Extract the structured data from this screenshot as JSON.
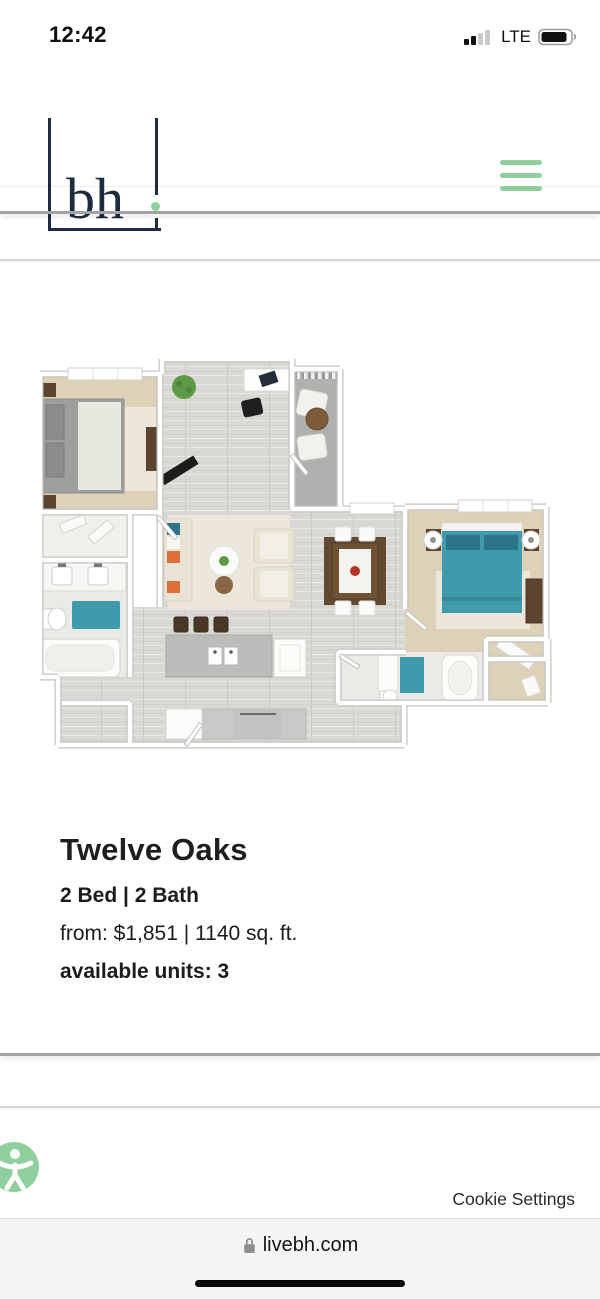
{
  "status_bar": {
    "time": "12:42",
    "network_label": "LTE",
    "signal_bars_filled": 2,
    "signal_bars_total": 4,
    "battery_level_percent": 85
  },
  "header": {
    "logo_text": "bh"
  },
  "listing": {
    "title": "Twelve Oaks",
    "beds_baths": "2 Bed | 2 Bath",
    "price_area": "from: $1,851 | 1140 sq. ft.",
    "availability": "available units: 3"
  },
  "floorplan": {
    "alt": "3D rendered floor plan of a 2 bedroom, 2 bathroom apartment with balcony, office nook, open kitchen, living and dining areas",
    "colors": {
      "floor": "#d9d8d5",
      "carpet": "#ddd2b8",
      "bath_floor": "#eaeae7",
      "balcony": "#b0b0ae",
      "teal": "#3f9aab",
      "teal_dark": "#2c7487",
      "wood": "#5d4430",
      "bed_gray": "#9e9e9c",
      "rug_cream": "#ece7da",
      "sofa_cream": "#e8e3d5",
      "orange": "#dd7038",
      "plant_green": "#5d9b46",
      "wall_shadow": "#c3c3c1"
    }
  },
  "footer": {
    "cookie_settings": "Cookie Settings"
  },
  "browser_bar": {
    "url": "livebh.com"
  },
  "theme": {
    "accent_green": "#8fcf9e",
    "logo_navy": "#1d2b3f"
  }
}
